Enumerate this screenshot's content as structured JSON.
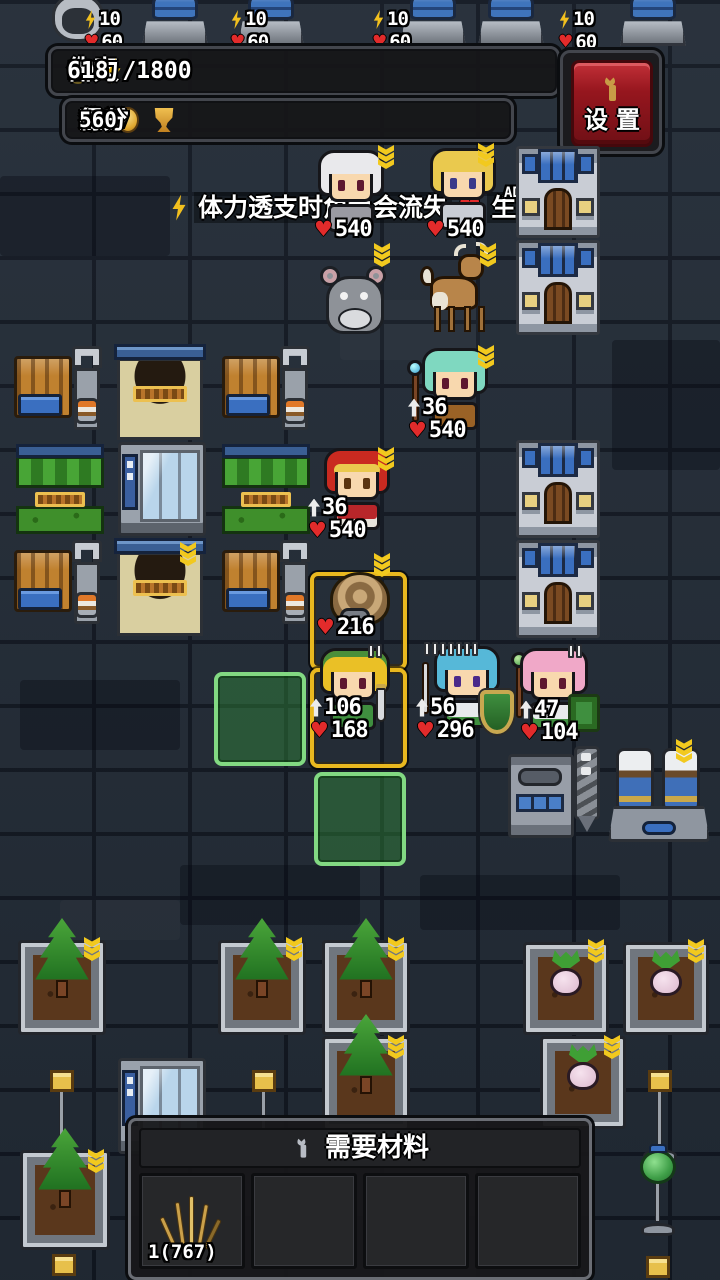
{
  "hud": {
    "day_label": "白天",
    "day_value": "196 / 800",
    "stamina_label": "体力",
    "stamina_value": "618 /1800",
    "honor_label": "荣誉",
    "honor_value": "322",
    "gold_label": "金币",
    "gold_value": "1277",
    "score_label": "得分",
    "score_value": "560",
    "settings_label": "设置"
  },
  "top_bar_units": {
    "power": "10",
    "hp": "60"
  },
  "tooltip": {
    "text_before_heart": "体力透支时角色会流失",
    "text_after_heart": "生命。"
  },
  "floating_text": "AD",
  "units": {
    "elder": {
      "hp": "540"
    },
    "elf_archer": {
      "hp": "540"
    },
    "healer": {
      "atk": "36",
      "hp": "540"
    },
    "red_hood": {
      "atk": "36",
      "hp": "540"
    },
    "snail": {
      "hp": "216"
    },
    "sword_girl": {
      "atk": "106",
      "hp": "168"
    },
    "knight": {
      "atk": "56",
      "hp": "296"
    },
    "mage": {
      "atk": "47",
      "hp": "104"
    }
  },
  "materials_panel": {
    "title": "需要材料",
    "slots": [
      {
        "count": "1(767)"
      },
      {},
      {},
      {}
    ]
  },
  "colors": {
    "accent_gold": "#f2c91e",
    "hp_red": "#e22b2b",
    "selection_yellow": "#e9b81f",
    "highlight_green": "#82d982",
    "settings_red": "#96161e"
  }
}
